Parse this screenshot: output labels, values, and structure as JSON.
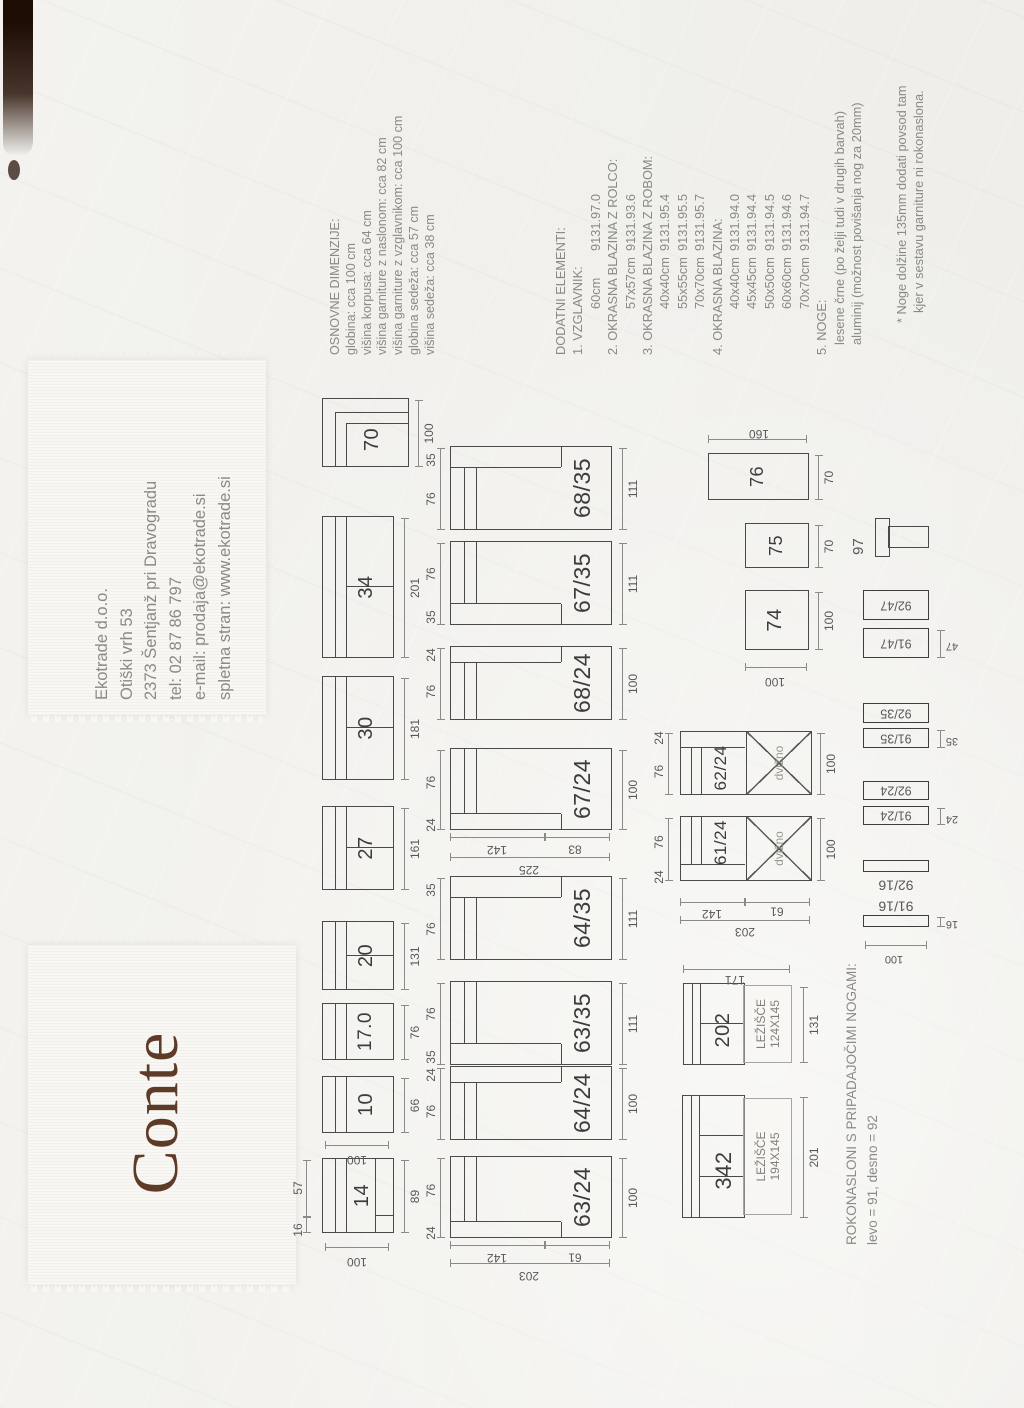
{
  "title": "Conte",
  "colors": {
    "title_brown": "#5d3b27",
    "scan_streak": "#1d0d05",
    "paper": "#f1f0ec"
  },
  "contact": {
    "lines": [
      "Ekotrade d.o.o.",
      "Otiški vrh 53",
      "2373 Šentjanž pri Dravogradu",
      "tel: 02 87 86 797",
      "e-mail: prodaja@ekotrade.si",
      "spletna stran: www.ekotrade.si"
    ]
  },
  "basic_dimensions": {
    "heading": "OSNOVNE DIMENZIJE:",
    "lines": [
      "globina: cca 100 cm",
      "višina korpusa: cca 64 cm",
      "višina garniture z naslonom: cca 82 cm",
      "višina garniture z vzglavnikom: cca 100 cm",
      "globina sedeža: cca 57 cm",
      "višina sedeža: cca 38 cm"
    ]
  },
  "additional": {
    "heading": "DODATNI ELEMENTI:",
    "h1": "1. VZGLAVNIK:",
    "r1": {
      "size": "60cm",
      "code": "9131.97.0"
    },
    "h2": "2. OKRASNA BLAZINA Z ROLCO:",
    "r2": {
      "size": "57x57cm",
      "code": "9131.93.6"
    },
    "h3": "3. OKRASNA BLAZINA Z ROBOM:",
    "r3a": {
      "size": "40x40cm",
      "code": "9131.95.4"
    },
    "r3b": {
      "size": "55x55cm",
      "code": "9131.95.5"
    },
    "r3c": {
      "size": "70x70cm",
      "code": "9131.95.7"
    },
    "h4": "4. OKRASNA BLAZINA:",
    "r4a": {
      "size": "40x40cm",
      "code": "9131.94.0"
    },
    "r4b": {
      "size": "45x45cm",
      "code": "9131.94.4"
    },
    "r4c": {
      "size": "50x50cm",
      "code": "9131.94.5"
    },
    "r4d": {
      "size": "60x60cm",
      "code": "9131.94.6"
    },
    "r4e": {
      "size": "70x70cm",
      "code": "9131.94.7"
    },
    "h5": "5. NOGE:",
    "r5a": "lesene črne (po želji tudi v drugih barvah)",
    "r5b": "aluminij (možnost povišanja nog za 20mm)"
  },
  "footnote": {
    "line1": "* Noge dolžine 135mm dodati povsod tam",
    "line2": "kjer v sestavu garniture ni rokonaslona."
  },
  "armrest_note": {
    "line1": "ROKONASLONI S PRIPADAJOČIMI NOGAMI:",
    "line2": "levo = 91, desno = 92"
  },
  "diagrams": {
    "row1": [
      {
        "id": "14",
        "w": "89",
        "depth": "100",
        "seg1": "16",
        "seg2": "57"
      },
      {
        "id": "10",
        "w": "66",
        "depth": "100"
      },
      {
        "id": "17.0",
        "w": "76"
      },
      {
        "id": "20",
        "w": "131"
      },
      {
        "id": "27",
        "w": "161"
      },
      {
        "id": "30",
        "w": "181"
      },
      {
        "id": "34",
        "w": "201"
      },
      {
        "id": "70",
        "w": "100"
      }
    ],
    "row2": [
      {
        "id": "63/24",
        "arm": "24",
        "seat": "76",
        "w": "100"
      },
      {
        "id": "64/24",
        "arm": "24",
        "seat": "76",
        "w": "100"
      },
      {
        "id": "63/35",
        "arm": "35",
        "seat": "76",
        "w": "111"
      },
      {
        "id": "64/35",
        "arm": "35",
        "seat": "76",
        "w": "111"
      },
      {
        "id": "67/24",
        "arm": "24",
        "seat": "76",
        "w": "100"
      },
      {
        "id": "68/24",
        "arm": "24",
        "seat": "76",
        "w": "100"
      },
      {
        "id": "67/35",
        "arm": "35",
        "seat": "76",
        "w": "111"
      },
      {
        "id": "68/35",
        "arm": "35",
        "seat": "76",
        "w": "111"
      }
    ],
    "row2_vdims": {
      "seg1": "142",
      "seg2": "83",
      "total": "225"
    },
    "chaise_vdims": {
      "seg1": "142",
      "seg2": "61",
      "total": "203"
    },
    "lift": [
      {
        "id": "61/24",
        "arm": "24",
        "seat": "76",
        "w": "100",
        "tag": "dvižno",
        "vd": {
          "seg1": "142",
          "seg2": "61",
          "total": "203"
        }
      },
      {
        "id": "62/24",
        "arm": "24",
        "seat": "76",
        "w": "100",
        "tag": "dvižno"
      }
    ],
    "beds": [
      {
        "id": "342",
        "bed_line1": "LEŽIŠČE",
        "bed_line2": "194X145",
        "width": "201"
      },
      {
        "id": "202",
        "bed_line1": "LEŽIŠČE",
        "bed_line2": "124X145",
        "width": "131",
        "height": "171"
      }
    ],
    "poufs": [
      {
        "id": "74",
        "width": "100",
        "depth": "100"
      },
      {
        "id": "75",
        "width": "70"
      },
      {
        "id": "76",
        "width": "70",
        "length": "160"
      }
    ],
    "leg": {
      "label": "97"
    },
    "armrests": {
      "depth": "100",
      "pairs": [
        {
          "right": "92/47",
          "left": "91/47",
          "dim": "47"
        },
        {
          "right": "92/35",
          "left": "91/35",
          "dim": "35"
        },
        {
          "right": "92/24",
          "left": "91/24",
          "dim": "24"
        },
        {
          "right": "92/16",
          "left": "91/16",
          "dim": "16"
        }
      ]
    }
  }
}
